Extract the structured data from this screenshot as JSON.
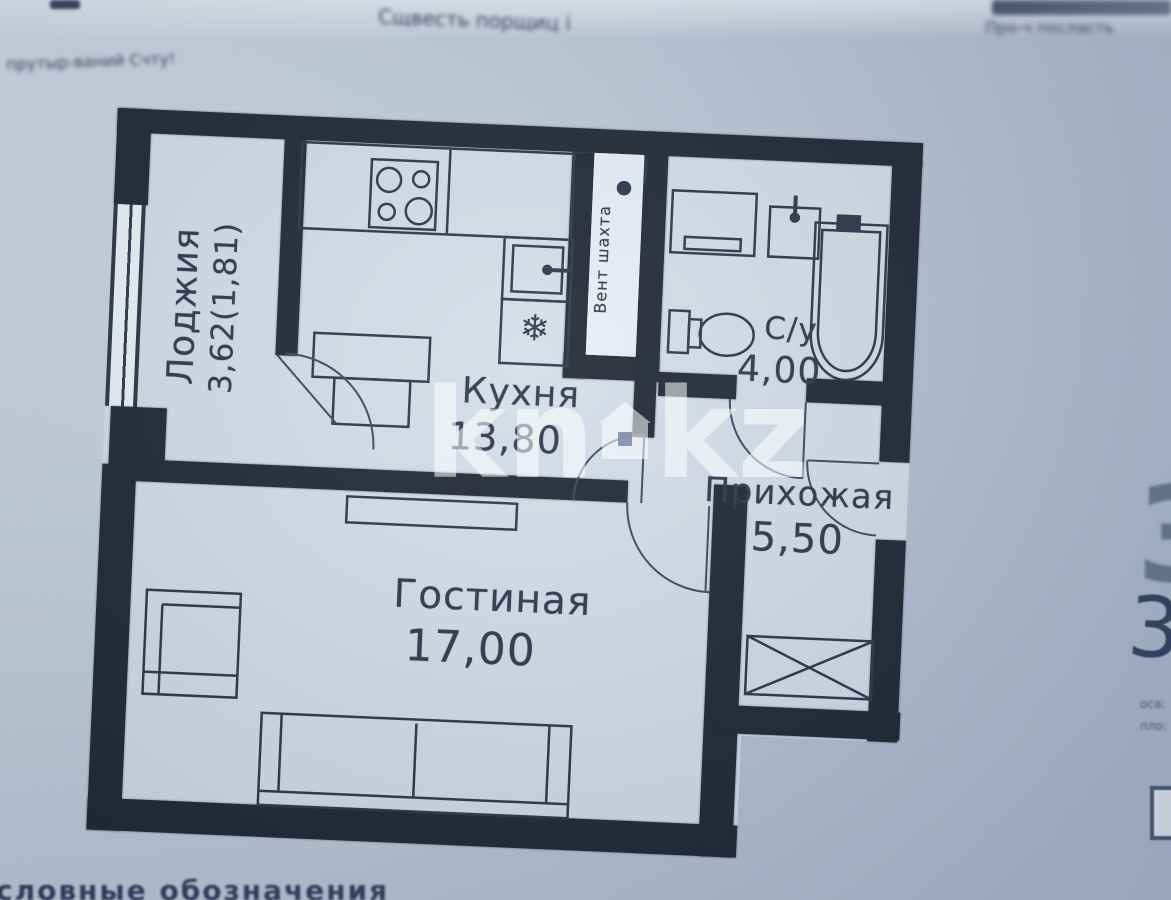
{
  "photo": {
    "watermark": {
      "left": "kn",
      "right": "kz"
    },
    "legend_caption": "словные обозначения",
    "notes": {
      "top_left": "прутыр-ваний Счту!",
      "top_center": "Сщвесть порщиц і",
      "top_right": "Про-ч посласть",
      "right_digit_large": "3",
      "right_digit_hand": "3",
      "right_small_line1": "оса:",
      "right_small_line2": "пло:"
    },
    "rooms": {
      "loggia": {
        "name": "Лоджия",
        "area": "3,62(1,81)"
      },
      "kitchen": {
        "name": "Кухня",
        "area": "13,80"
      },
      "vent": {
        "name": "Вент шахта"
      },
      "bathroom": {
        "name": "С/у",
        "area": "4,00"
      },
      "hallway": {
        "name": "Прихожая",
        "area": "5,50"
      },
      "living": {
        "name": "Гостиная",
        "area": "17,00"
      }
    },
    "fixtures": {
      "fridge_glyph": "❄"
    }
  }
}
